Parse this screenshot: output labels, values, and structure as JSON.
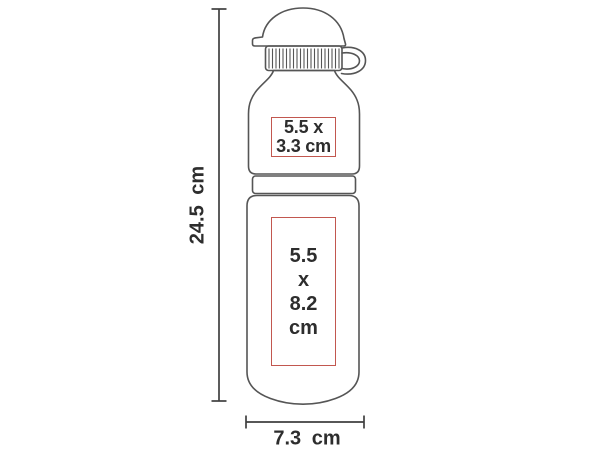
{
  "dimensions": {
    "height_label": "24.5 cm",
    "width_label": "7.3 cm"
  },
  "print_areas": [
    {
      "lines": [
        "5.5 x",
        "3.3 cm"
      ]
    },
    {
      "lines": [
        "5.5",
        "x",
        "8.2",
        "cm"
      ]
    }
  ],
  "colors": {
    "outline": "#555555",
    "dimension": "#3f3f3f",
    "label_text": "#2d2d2d",
    "print_border": "#c2574f",
    "background": "#ffffff"
  }
}
